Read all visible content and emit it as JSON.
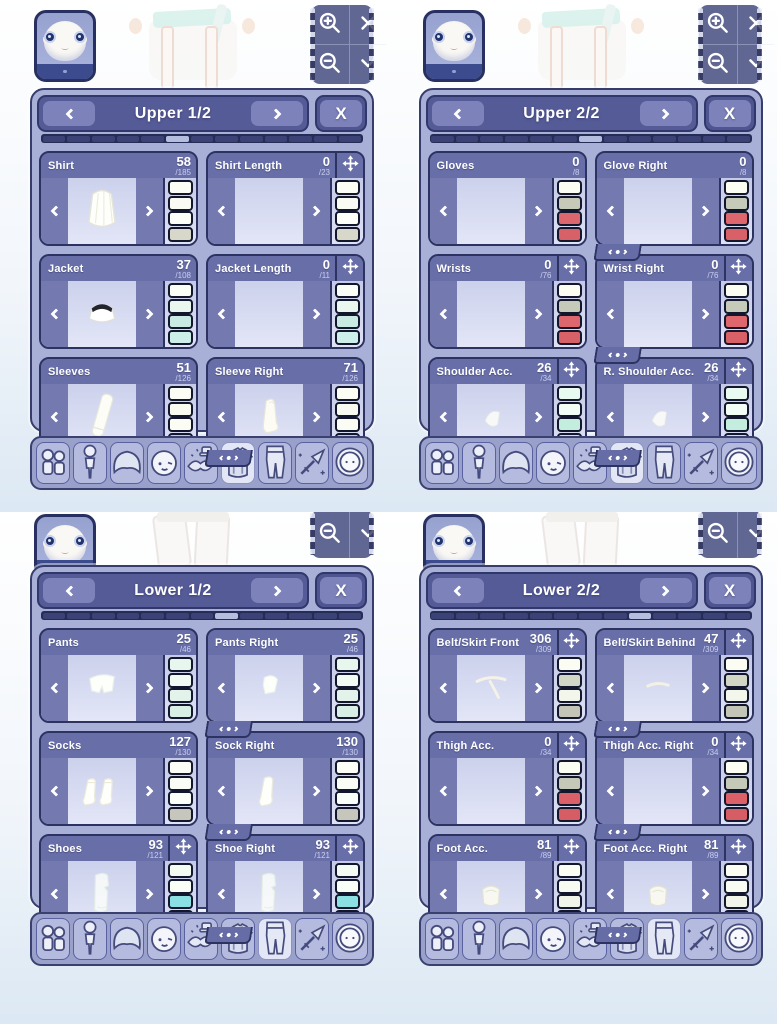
{
  "labels": {
    "close": "X"
  },
  "tab_bar": {
    "items": [
      {
        "icon": "presets-icon"
      },
      {
        "icon": "body-icon"
      },
      {
        "icon": "hair-icon"
      },
      {
        "icon": "face-icon"
      },
      {
        "icon": "accessories-icon"
      },
      {
        "icon": "top-clothes-icon"
      },
      {
        "icon": "bottom-clothes-icon"
      },
      {
        "icon": "weapon-icon"
      },
      {
        "icon": "other-icon"
      }
    ]
  },
  "camera_controls": {
    "full": [
      "zoom-in-icon",
      "close-icon",
      "zoom-out-icon",
      "collapse-icon"
    ],
    "half": [
      "zoom-out-icon",
      "collapse-icon"
    ]
  },
  "panels": [
    {
      "title": "Upper 1/2",
      "variant": "top",
      "progress": {
        "segments": 13,
        "active": 5
      },
      "active_tab": 5,
      "sections": [
        {
          "label": "Shirt",
          "value": "58",
          "total": "/185",
          "move": false,
          "mirror": false,
          "preview": "shirt",
          "swatches": [
            "#fcfdf5",
            "#fafcf3",
            "#fcfef7",
            "#d7d7ca"
          ]
        },
        {
          "label": "Shirt Length",
          "value": "0",
          "total": "/23",
          "move": true,
          "mirror": false,
          "preview": "none",
          "swatches": [
            "#fcfdf5",
            "#fafcf3",
            "#fcfef7",
            "#d7d7ca"
          ]
        },
        {
          "label": "Jacket",
          "value": "37",
          "total": "/108",
          "move": false,
          "mirror": false,
          "preview": "jacket",
          "swatches": [
            "#fbfdf7",
            "#eaf7ef",
            "#c9e9e3",
            "#cdefe9"
          ]
        },
        {
          "label": "Jacket Length",
          "value": "0",
          "total": "/11",
          "move": true,
          "mirror": false,
          "preview": "none",
          "swatches": [
            "#fbfdf7",
            "#eaf7ef",
            "#c9e9e3",
            "#cdefe9"
          ]
        },
        {
          "label": "Sleeves",
          "value": "51",
          "total": "/126",
          "move": false,
          "mirror": false,
          "preview": "sleeve",
          "swatches": [
            "#fcfdf5",
            "#f9fbf1",
            "#fbfdf5",
            "#c9c9c0"
          ]
        },
        {
          "label": "Sleeve Right",
          "value": "71",
          "total": "/126",
          "move": false,
          "mirror": true,
          "preview": "sleeve_r",
          "swatches": [
            "#fcfdf5",
            "#f9fbf1",
            "#fbfdf5",
            "#c9c9c0"
          ]
        }
      ]
    },
    {
      "title": "Upper 2/2",
      "variant": "top",
      "progress": {
        "segments": 13,
        "active": 6
      },
      "active_tab": 5,
      "sections": [
        {
          "label": "Gloves",
          "value": "0",
          "total": "/8",
          "move": false,
          "mirror": false,
          "preview": "none",
          "swatches": [
            "#fbfdf2",
            "#c6cab9",
            "#de666d",
            "#d86067"
          ]
        },
        {
          "label": "Glove Right",
          "value": "0",
          "total": "/8",
          "move": false,
          "mirror": true,
          "preview": "none",
          "swatches": [
            "#fbfdf2",
            "#c6cab9",
            "#de666d",
            "#d86067"
          ]
        },
        {
          "label": "Wrists",
          "value": "0",
          "total": "/76",
          "move": true,
          "mirror": false,
          "preview": "none",
          "swatches": [
            "#fbfdf2",
            "#c6cab9",
            "#de666d",
            "#d86067"
          ]
        },
        {
          "label": "Wrist Right",
          "value": "0",
          "total": "/76",
          "move": true,
          "mirror": true,
          "preview": "none",
          "swatches": [
            "#fbfdf2",
            "#c6cab9",
            "#de666d",
            "#d86067"
          ]
        },
        {
          "label": "Shoulder Acc.",
          "value": "26",
          "total": "/34",
          "move": true,
          "mirror": false,
          "preview": "shoulder",
          "swatches": [
            "#e9fbf1",
            "#f1fdf5",
            "#c3eddd",
            "#cee1d7"
          ]
        },
        {
          "label": "R. Shoulder Acc.",
          "value": "26",
          "total": "/34",
          "move": true,
          "mirror": true,
          "preview": "shoulder",
          "swatches": [
            "#e9fbf1",
            "#f1fdf5",
            "#c3eddd",
            "#cee1d7"
          ]
        }
      ]
    },
    {
      "title": "Lower 1/2",
      "variant": "bottom",
      "progress": {
        "segments": 13,
        "active": 7
      },
      "active_tab": 6,
      "sections": [
        {
          "label": "Pants",
          "value": "25",
          "total": "/46",
          "move": false,
          "mirror": false,
          "preview": "shorts",
          "swatches": [
            "#e7f7ed",
            "#f1fbf3",
            "#e3f3eb",
            "#d7efe5"
          ]
        },
        {
          "label": "Pants Right",
          "value": "25",
          "total": "/46",
          "move": false,
          "mirror": true,
          "preview": "shorts_r",
          "swatches": [
            "#e7f7ed",
            "#f1fbf3",
            "#e3f3eb",
            "#d7efe5"
          ]
        },
        {
          "label": "Socks",
          "value": "127",
          "total": "/130",
          "move": false,
          "mirror": false,
          "preview": "socks",
          "swatches": [
            "#fbfdf6",
            "#f9fdf5",
            "#fbfff9",
            "#c6c6bd"
          ]
        },
        {
          "label": "Sock Right",
          "value": "130",
          "total": "/130",
          "move": false,
          "mirror": true,
          "preview": "sock",
          "swatches": [
            "#fbfdf6",
            "#f9fdf5",
            "#fbfff9",
            "#c6c6bd"
          ]
        },
        {
          "label": "Shoes",
          "value": "93",
          "total": "/121",
          "move": true,
          "mirror": false,
          "preview": "boot",
          "swatches": [
            "#f3fbf3",
            "#f9fef7",
            "#8be0e3",
            "#d6efde"
          ]
        },
        {
          "label": "Shoe Right",
          "value": "93",
          "total": "/121",
          "move": true,
          "mirror": true,
          "preview": "boot",
          "swatches": [
            "#f3fbf3",
            "#f9fef7",
            "#8be0e3",
            "#d6efde"
          ]
        }
      ]
    },
    {
      "title": "Lower 2/2",
      "variant": "bottom",
      "progress": {
        "segments": 13,
        "active": 8
      },
      "active_tab": 6,
      "sections": [
        {
          "label": "Belt/Skirt Front",
          "value": "306",
          "total": "/309",
          "move": true,
          "mirror": false,
          "preview": "belt_f",
          "swatches": [
            "#fbfdf2",
            "#d1d6c5",
            "#f3f7eb",
            "#c3c5b6"
          ]
        },
        {
          "label": "Belt/Skirt Behind",
          "value": "47",
          "total": "/309",
          "move": true,
          "mirror": true,
          "preview": "belt_b",
          "swatches": [
            "#fbfdf2",
            "#d1d6c5",
            "#f3f7eb",
            "#c3c5b6"
          ]
        },
        {
          "label": "Thigh Acc.",
          "value": "0",
          "total": "/34",
          "move": true,
          "mirror": false,
          "preview": "none",
          "swatches": [
            "#fbfdf2",
            "#c5c9b7",
            "#db6067",
            "#d65d64"
          ]
        },
        {
          "label": "Thigh Acc. Right",
          "value": "0",
          "total": "/34",
          "move": true,
          "mirror": true,
          "preview": "none",
          "swatches": [
            "#fbfdf2",
            "#c5c9b7",
            "#db6067",
            "#d65d64"
          ]
        },
        {
          "label": "Foot Acc.",
          "value": "81",
          "total": "/89",
          "move": true,
          "mirror": false,
          "preview": "pouch",
          "swatches": [
            "#fbfdf2",
            "#f7fbf1",
            "#f1f5e9",
            "#c3c7b5"
          ]
        },
        {
          "label": "Foot Acc. Right",
          "value": "81",
          "total": "/89",
          "move": true,
          "mirror": true,
          "preview": "pouch",
          "swatches": [
            "#fbfdf2",
            "#f7fbf1",
            "#f1f5e9",
            "#c3c7b5"
          ]
        }
      ]
    }
  ]
}
